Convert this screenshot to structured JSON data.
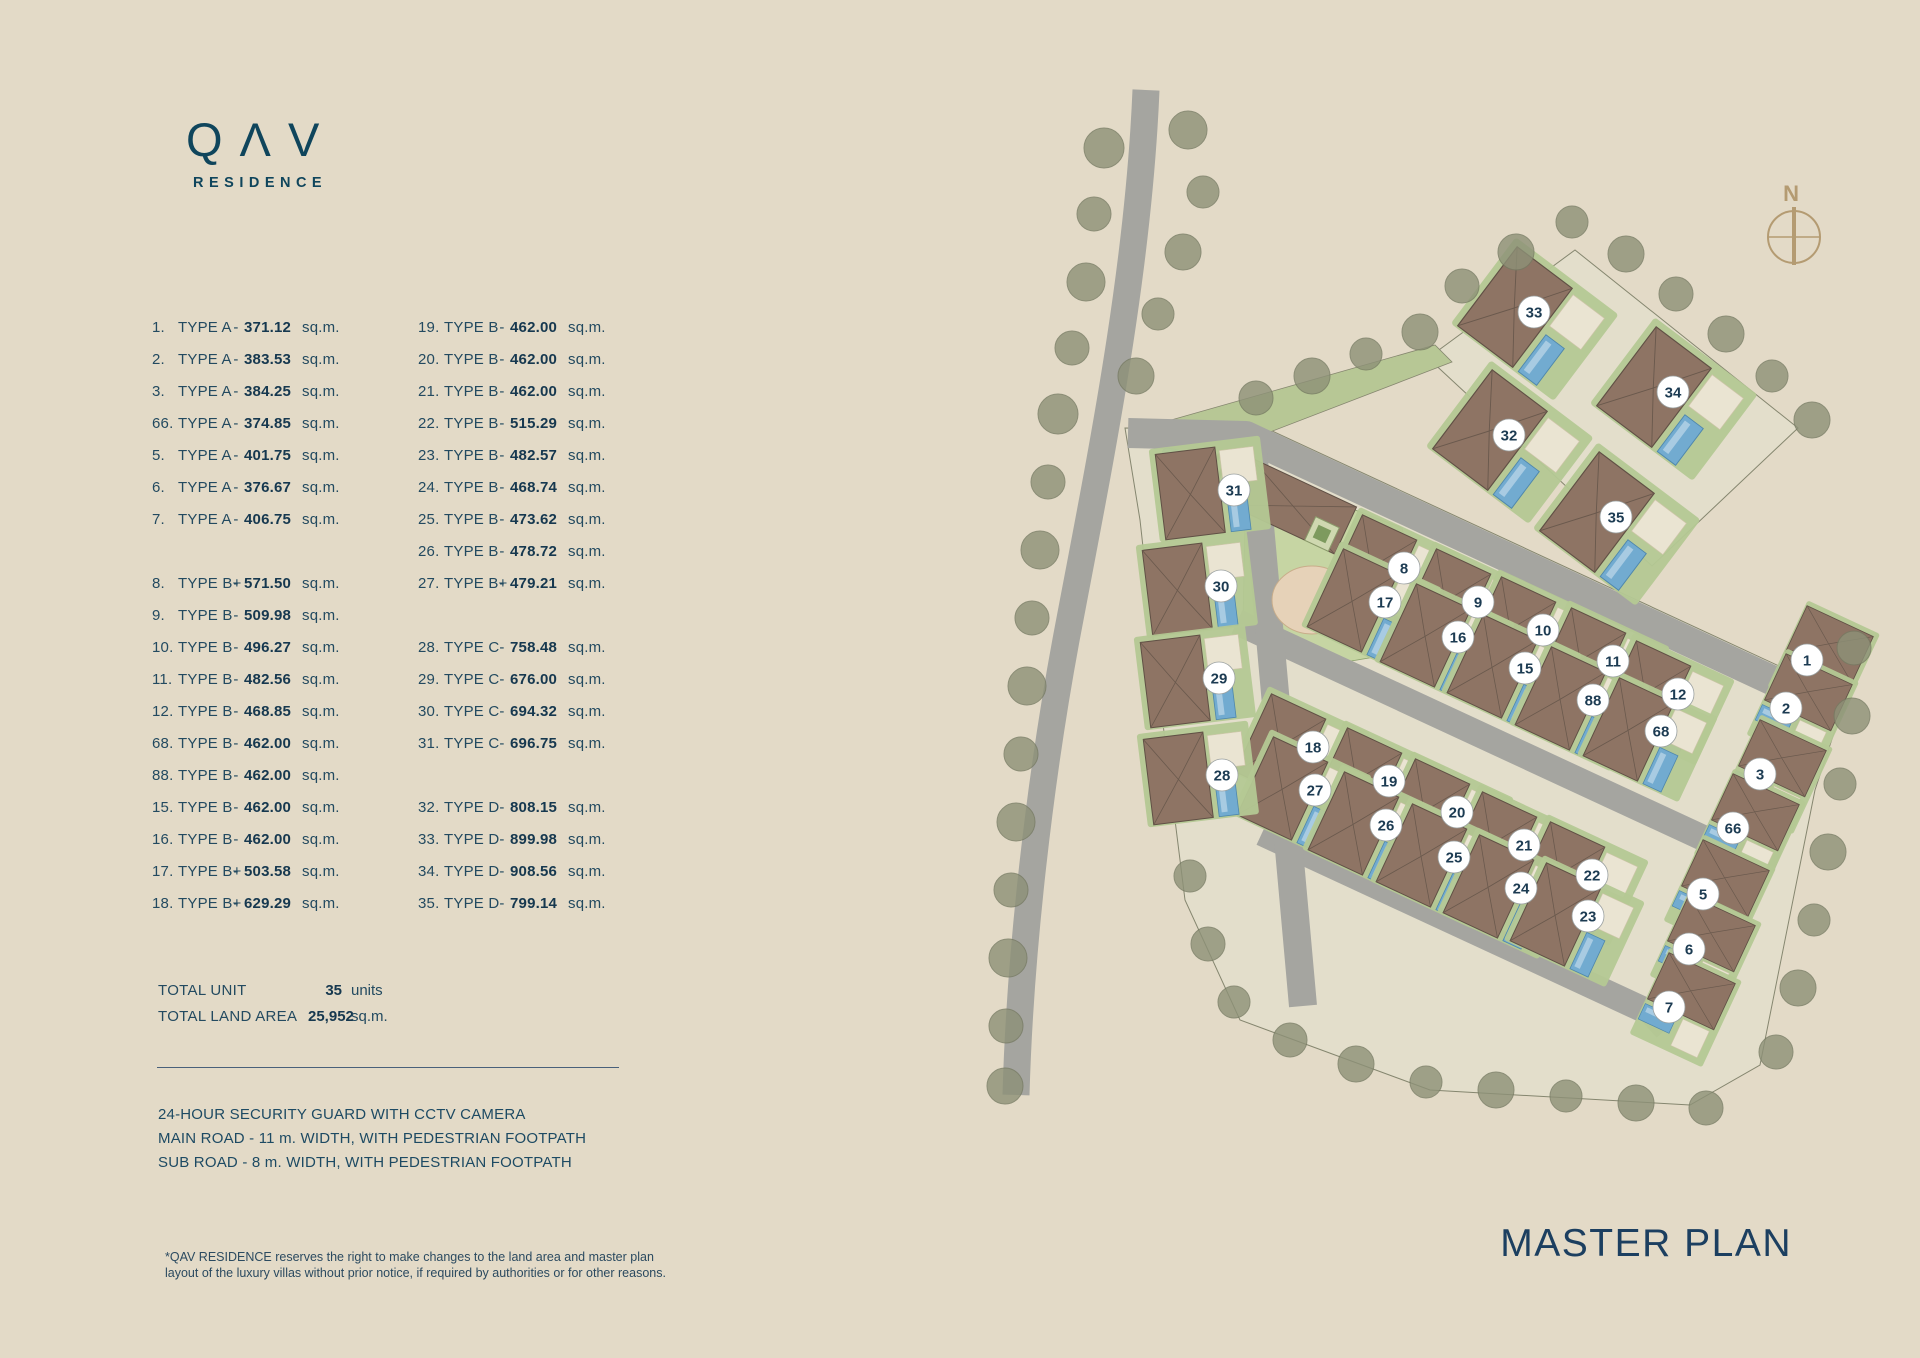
{
  "logo": {
    "name": "QΛV",
    "sub": "RESIDENCE"
  },
  "legend": {
    "columns": [
      {
        "groups": [
          [
            {
              "no": "1.",
              "type": "TYPE A",
              "dash": "-",
              "area": "371.12",
              "unit": "sq.m."
            },
            {
              "no": "2.",
              "type": "TYPE A",
              "dash": "-",
              "area": "383.53",
              "unit": "sq.m."
            },
            {
              "no": "3.",
              "type": "TYPE A",
              "dash": "-",
              "area": "384.25",
              "unit": "sq.m."
            },
            {
              "no": "66.",
              "type": "TYPE A",
              "dash": "-",
              "area": "374.85",
              "unit": "sq.m."
            },
            {
              "no": "5.",
              "type": "TYPE A",
              "dash": "-",
              "area": "401.75",
              "unit": "sq.m."
            },
            {
              "no": "6.",
              "type": "TYPE A",
              "dash": "-",
              "area": "376.67",
              "unit": "sq.m."
            },
            {
              "no": "7.",
              "type": "TYPE A",
              "dash": "-",
              "area": "406.75",
              "unit": "sq.m."
            }
          ],
          [
            {
              "no": "8.",
              "type": "TYPE B+",
              "dash": "-",
              "area": "571.50",
              "unit": "sq.m."
            },
            {
              "no": "9.",
              "type": "TYPE B",
              "dash": "-",
              "area": "509.98",
              "unit": "sq.m."
            },
            {
              "no": "10.",
              "type": "TYPE B",
              "dash": "-",
              "area": "496.27",
              "unit": "sq.m."
            },
            {
              "no": "11.",
              "type": "TYPE B",
              "dash": "-",
              "area": "482.56",
              "unit": "sq.m."
            },
            {
              "no": "12.",
              "type": "TYPE B",
              "dash": "-",
              "area": "468.85",
              "unit": "sq.m."
            },
            {
              "no": "68.",
              "type": "TYPE B",
              "dash": "-",
              "area": "462.00",
              "unit": "sq.m."
            },
            {
              "no": "88.",
              "type": "TYPE B",
              "dash": "-",
              "area": "462.00",
              "unit": "sq.m."
            },
            {
              "no": "15.",
              "type": "TYPE B",
              "dash": "-",
              "area": "462.00",
              "unit": "sq.m."
            },
            {
              "no": "16.",
              "type": "TYPE B",
              "dash": "-",
              "area": "462.00",
              "unit": "sq.m."
            },
            {
              "no": "17.",
              "type": "TYPE B+",
              "dash": "-",
              "area": "503.58",
              "unit": "sq.m."
            },
            {
              "no": "18.",
              "type": "TYPE B+",
              "dash": "-",
              "area": "629.29",
              "unit": "sq.m."
            }
          ]
        ]
      },
      {
        "groups": [
          [
            {
              "no": "19.",
              "type": "TYPE B",
              "dash": "-",
              "area": "462.00",
              "unit": "sq.m."
            },
            {
              "no": "20.",
              "type": "TYPE B",
              "dash": "-",
              "area": "462.00",
              "unit": "sq.m."
            },
            {
              "no": "21.",
              "type": "TYPE B",
              "dash": "-",
              "area": "462.00",
              "unit": "sq.m."
            },
            {
              "no": "22.",
              "type": "TYPE B",
              "dash": "-",
              "area": "515.29",
              "unit": "sq.m."
            },
            {
              "no": "23.",
              "type": "TYPE B",
              "dash": "-",
              "area": "482.57",
              "unit": "sq.m."
            },
            {
              "no": "24.",
              "type": "TYPE B",
              "dash": "-",
              "area": "468.74",
              "unit": "sq.m."
            },
            {
              "no": "25.",
              "type": "TYPE B",
              "dash": "-",
              "area": "473.62",
              "unit": "sq.m."
            },
            {
              "no": "26.",
              "type": "TYPE B",
              "dash": "-",
              "area": "478.72",
              "unit": "sq.m."
            },
            {
              "no": "27.",
              "type": "TYPE B+",
              "dash": "-",
              "area": "479.21",
              "unit": "sq.m."
            }
          ],
          [
            {
              "no": "28.",
              "type": "TYPE C",
              "dash": "-",
              "area": "758.48",
              "unit": "sq.m."
            },
            {
              "no": "29.",
              "type": "TYPE C",
              "dash": "-",
              "area": "676.00",
              "unit": "sq.m."
            },
            {
              "no": "30.",
              "type": "TYPE C",
              "dash": "-",
              "area": "694.32",
              "unit": "sq.m."
            },
            {
              "no": "31.",
              "type": "TYPE C",
              "dash": "-",
              "area": "696.75",
              "unit": "sq.m."
            }
          ],
          [
            {
              "no": "32.",
              "type": "TYPE D",
              "dash": "-",
              "area": "808.15",
              "unit": "sq.m."
            },
            {
              "no": "33.",
              "type": "TYPE D",
              "dash": "-",
              "area": "899.98",
              "unit": "sq.m."
            },
            {
              "no": "34.",
              "type": "TYPE D",
              "dash": "-",
              "area": "908.56",
              "unit": "sq.m."
            },
            {
              "no": "35.",
              "type": "TYPE D",
              "dash": "-",
              "area": "799.14",
              "unit": "sq.m."
            }
          ]
        ]
      }
    ]
  },
  "totals": {
    "unit_label": "TOTAL UNIT",
    "unit_value": "35",
    "unit_suffix": "units",
    "land_label": "TOTAL LAND AREA",
    "land_value": "25,952",
    "land_suffix": "sq.m."
  },
  "features": [
    "24-HOUR SECURITY GUARD WITH CCTV CAMERA",
    "MAIN ROAD - 11 m. WIDTH, WITH PEDESTRIAN FOOTPATH",
    "SUB ROAD - 8 m. WIDTH, WITH PEDESTRIAN FOOTPATH"
  ],
  "disclaimer": {
    "line1": "*QAV RESIDENCE reserves the right to make changes to the land area and master plan",
    "line2": "layout of the luxury villas without prior notice, if required by authorities or for other reasons."
  },
  "title": "MASTER PLAN",
  "compass": {
    "label": "N"
  },
  "plan_markers": [
    {
      "n": "33",
      "x": 1534,
      "y": 312,
      "g": "tr"
    },
    {
      "n": "34",
      "x": 1673,
      "y": 392,
      "g": "tr"
    },
    {
      "n": "32",
      "x": 1509,
      "y": 435,
      "g": "tr"
    },
    {
      "n": "35",
      "x": 1616,
      "y": 517,
      "g": "tr"
    },
    {
      "n": "8",
      "x": 1404,
      "y": 568,
      "g": "row"
    },
    {
      "n": "9",
      "x": 1478,
      "y": 602,
      "g": "row"
    },
    {
      "n": "10",
      "x": 1543,
      "y": 630,
      "g": "row"
    },
    {
      "n": "11",
      "x": 1613,
      "y": 661,
      "g": "row"
    },
    {
      "n": "12",
      "x": 1678,
      "y": 694,
      "g": "row"
    },
    {
      "n": "17",
      "x": 1385,
      "y": 602,
      "g": "row"
    },
    {
      "n": "16",
      "x": 1458,
      "y": 637,
      "g": "row"
    },
    {
      "n": "15",
      "x": 1525,
      "y": 668,
      "g": "row"
    },
    {
      "n": "88",
      "x": 1593,
      "y": 700,
      "g": "row"
    },
    {
      "n": "68",
      "x": 1661,
      "y": 731,
      "g": "row"
    },
    {
      "n": "18",
      "x": 1313,
      "y": 747,
      "g": "row"
    },
    {
      "n": "19",
      "x": 1389,
      "y": 781,
      "g": "row"
    },
    {
      "n": "20",
      "x": 1457,
      "y": 812,
      "g": "row"
    },
    {
      "n": "21",
      "x": 1524,
      "y": 845,
      "g": "row"
    },
    {
      "n": "22",
      "x": 1592,
      "y": 875,
      "g": "row"
    },
    {
      "n": "27",
      "x": 1315,
      "y": 790,
      "g": "row"
    },
    {
      "n": "26",
      "x": 1386,
      "y": 825,
      "g": "row"
    },
    {
      "n": "25",
      "x": 1454,
      "y": 857,
      "g": "row"
    },
    {
      "n": "24",
      "x": 1521,
      "y": 888,
      "g": "row"
    },
    {
      "n": "23",
      "x": 1588,
      "y": 916,
      "g": "row"
    },
    {
      "n": "31",
      "x": 1234,
      "y": 490,
      "g": "w"
    },
    {
      "n": "30",
      "x": 1221,
      "y": 586,
      "g": "w"
    },
    {
      "n": "29",
      "x": 1219,
      "y": 678,
      "g": "w"
    },
    {
      "n": "28",
      "x": 1222,
      "y": 775,
      "g": "w"
    },
    {
      "n": "1",
      "x": 1807,
      "y": 660,
      "g": "e"
    },
    {
      "n": "2",
      "x": 1786,
      "y": 708,
      "g": "e"
    },
    {
      "n": "3",
      "x": 1760,
      "y": 774,
      "g": "e"
    },
    {
      "n": "66",
      "x": 1733,
      "y": 828,
      "g": "e"
    },
    {
      "n": "5",
      "x": 1703,
      "y": 894,
      "g": "e"
    },
    {
      "n": "6",
      "x": 1689,
      "y": 949,
      "g": "e"
    },
    {
      "n": "7",
      "x": 1669,
      "y": 1007,
      "g": "e"
    }
  ],
  "colors": {
    "background": "#e3dac7",
    "text_navy": "#16455c",
    "road_gray": "#a5a5a0",
    "roof_brown": "#8e7464",
    "pool_blue": "#72abd0",
    "lawn_green": "#b4c893",
    "tree_olive": "#8d9177",
    "compass_tan": "#b49b72"
  }
}
